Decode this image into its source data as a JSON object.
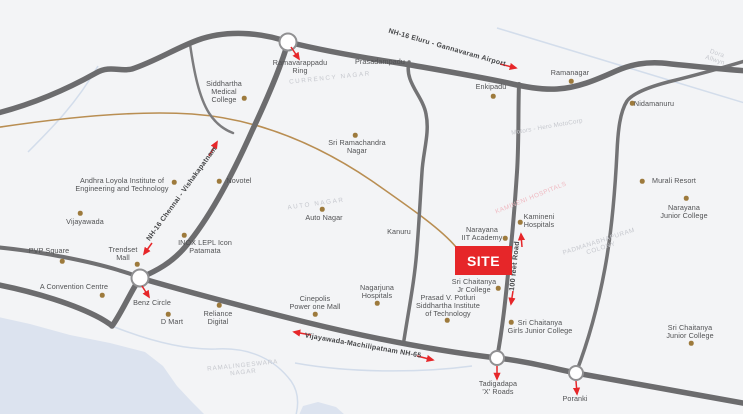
{
  "site": {
    "label": "SITE",
    "color": "#e62629"
  },
  "roads": {
    "nh16_top": "NH-16 Eluru - Gannavaram Airport",
    "nh16_diag": "NH-16 Chennai - Vishakapatnam",
    "nh65": "Vijayawada-Machilipatnam NH-65",
    "feet_road": "100 feet Road"
  },
  "colors": {
    "accent_red": "#e62629",
    "road_gray": "#6c6c6e",
    "railway_tan": "#b98e52",
    "water_blue": "#dce3ef",
    "dot_brown": "#9d7a3c"
  },
  "landmarks": [
    {
      "label": "Ramavarappadu\nRing",
      "x": 300,
      "y": 67
    },
    {
      "label": "Siddhartha\nMedical\nCollege",
      "x": 224,
      "y": 92,
      "dot": [
        244,
        98
      ]
    },
    {
      "label": "Prasadampadu",
      "x": 380,
      "y": 62
    },
    {
      "label": "Enkipadu",
      "x": 491,
      "y": 87,
      "dot": [
        493,
        96
      ]
    },
    {
      "label": "Ramanagar",
      "x": 570,
      "y": 73,
      "dot": [
        571,
        81
      ]
    },
    {
      "label": "Nidamanuru",
      "x": 654,
      "y": 104,
      "dot": [
        632,
        103
      ]
    },
    {
      "label": "Sri Ramachandra\nNagar",
      "x": 357,
      "y": 147,
      "dot": [
        355,
        135
      ]
    },
    {
      "label": "Andhra Loyola Institute of\nEngineering and Technology",
      "x": 122,
      "y": 185,
      "dot": [
        174,
        182
      ]
    },
    {
      "label": "Novotel",
      "x": 239,
      "y": 181,
      "dot": [
        219,
        181
      ]
    },
    {
      "label": "Vijayawada",
      "x": 85,
      "y": 222,
      "dot": [
        80,
        213
      ]
    },
    {
      "label": "Murali Resort",
      "x": 674,
      "y": 181,
      "dot": [
        642,
        181
      ]
    },
    {
      "label": "Narayana\nJunior College",
      "x": 684,
      "y": 212,
      "dot": [
        686,
        198
      ]
    },
    {
      "label": "Auto Nagar",
      "x": 324,
      "y": 218,
      "dot": [
        322,
        209
      ]
    },
    {
      "label": "INOX LEPL Icon\nPatamata",
      "x": 205,
      "y": 247,
      "dot": [
        184,
        235
      ]
    },
    {
      "label": "Trendset\nMall",
      "x": 123,
      "y": 254,
      "dot": [
        137,
        264
      ]
    },
    {
      "label": "PVP Square",
      "x": 49,
      "y": 251,
      "dot": [
        62,
        261
      ]
    },
    {
      "label": "A Convention Centre",
      "x": 74,
      "y": 287,
      "dot": [
        102,
        295
      ]
    },
    {
      "label": "Benz Circle",
      "x": 152,
      "y": 303
    },
    {
      "label": "D Mart",
      "x": 172,
      "y": 322,
      "dot": [
        168,
        314
      ]
    },
    {
      "label": "Reliance\nDigital",
      "x": 218,
      "y": 318,
      "dot": [
        219,
        305
      ]
    },
    {
      "label": "Cinepolis\nPower one Mall",
      "x": 315,
      "y": 303,
      "dot": [
        315,
        314
      ]
    },
    {
      "label": "Nagarjuna\nHospitals",
      "x": 377,
      "y": 292,
      "dot": [
        377,
        303
      ]
    },
    {
      "label": "Kanuru",
      "x": 399,
      "y": 232
    },
    {
      "label": "Narayana\nIIT Academy",
      "x": 482,
      "y": 234,
      "dot": [
        505,
        238
      ]
    },
    {
      "label": "Kamineni\nHospitals",
      "x": 539,
      "y": 221,
      "dot": [
        520,
        222
      ]
    },
    {
      "label": "Sri Chaitanya\nJr College",
      "x": 474,
      "y": 286,
      "dot": [
        498,
        288
      ]
    },
    {
      "label": "Prasad V. Potluri\nSiddhartha Institute\nof Technology",
      "x": 448,
      "y": 306,
      "dot": [
        447,
        320
      ]
    },
    {
      "label": "Sri Chaitanya\nGirls Junior College",
      "x": 540,
      "y": 327,
      "dot": [
        511,
        322
      ]
    },
    {
      "label": "Tadigadapa\n'X' Roads",
      "x": 498,
      "y": 388
    },
    {
      "label": "Poranki",
      "x": 575,
      "y": 399
    },
    {
      "label": "Sri Chaitanya\nJunior College",
      "x": 690,
      "y": 332,
      "dot": [
        691,
        343
      ]
    }
  ],
  "background_labels": [
    {
      "text": "CURRENCY NAGAR",
      "x": 330,
      "y": 78,
      "rot": -6,
      "ls": 1.6
    },
    {
      "text": "AUTO NAGAR",
      "x": 316,
      "y": 204,
      "rot": -8,
      "ls": 1.6
    },
    {
      "text": "RAMALINGESWARA\nNAGAR",
      "x": 243,
      "y": 369,
      "rot": -6,
      "ls": 0.8
    },
    {
      "text": "PADMANABHAPURAM\nCOLONY",
      "x": 600,
      "y": 245,
      "rot": -18,
      "ls": 0.6
    },
    {
      "text": "KAMINENI HOSPITALS",
      "x": 531,
      "y": 198,
      "rot": -22,
      "ls": 0.5,
      "color": "#efb8c0"
    },
    {
      "text": "Dora Allwyn",
      "x": 716,
      "y": 57,
      "rot": 18,
      "ls": 0.3
    },
    {
      "text": "Motors - Hero MotoCorp",
      "x": 547,
      "y": 127,
      "rot": -10,
      "ls": 0.2
    }
  ]
}
